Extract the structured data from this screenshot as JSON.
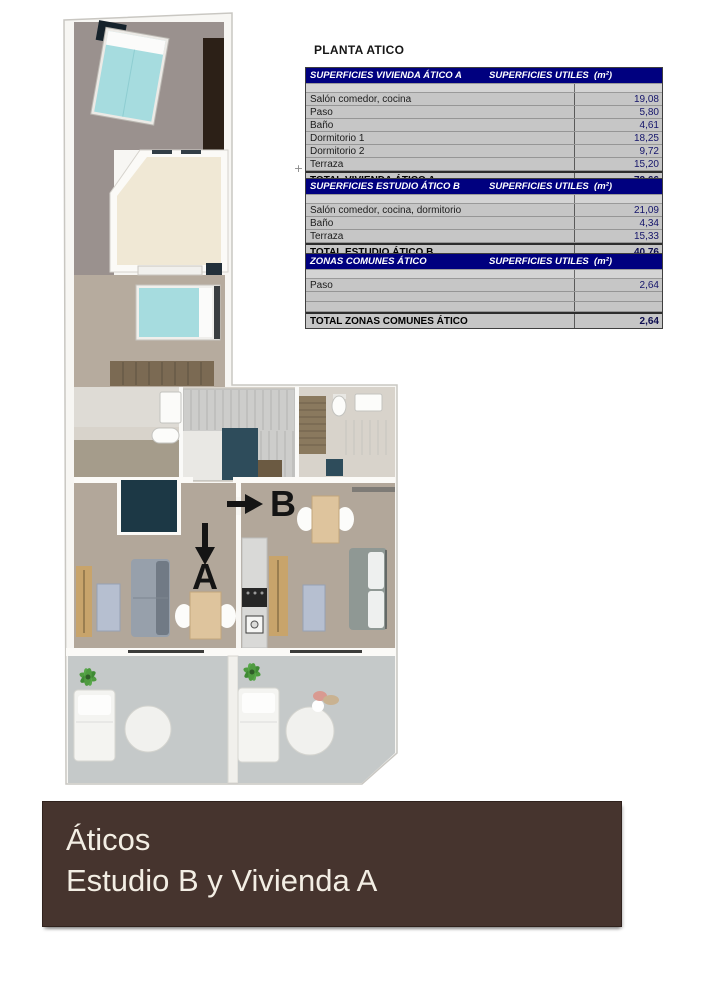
{
  "page": {
    "title": "PLANTA ATICO"
  },
  "plan": {
    "unit_a_label": "A",
    "unit_b_label": "B"
  },
  "markers": {
    "outline_plus": "+"
  },
  "tables": {
    "vivienda_a": {
      "header_left": "SUPERFICIES VIVIENDA ÁTICO A",
      "header_right": "SUPERFICIES UTILES  (m²)",
      "rows": [
        {
          "label": "Salón comedor, cocina",
          "value": "19,08"
        },
        {
          "label": "Paso",
          "value": "5,80"
        },
        {
          "label": "Baño",
          "value": "4,61"
        },
        {
          "label": "Dormitorio 1",
          "value": "18,25"
        },
        {
          "label": "Dormitorio 2",
          "value": "9,72"
        },
        {
          "label": "Terraza",
          "value": "15,20"
        }
      ],
      "total_label": "TOTAL VIVIENDA ÁTICO A",
      "total_value": "72,66"
    },
    "estudio_b": {
      "header_left": "SUPERFICIES ESTUDIO ÁTICO B",
      "header_right": "SUPERFICIES UTILES  (m²)",
      "rows": [
        {
          "label": "Salón comedor, cocina, dormitorio",
          "value": "21,09"
        },
        {
          "label": "Baño",
          "value": "4,34"
        },
        {
          "label": "Terraza",
          "value": "15,33"
        }
      ],
      "total_label": "TOTAL ESTUDIO ÁTICO B",
      "total_value": "40,76"
    },
    "zonas_comunes": {
      "header_left": "ZONAS COMUNES ÁTICO",
      "header_right": "SUPERFICIES UTILES  (m²)",
      "rows": [
        {
          "label": "Paso",
          "value": "2,64"
        },
        {
          "label": "",
          "value": ""
        },
        {
          "label": "",
          "value": ""
        }
      ],
      "total_label": "TOTAL ZONAS COMUNES ÁTICO",
      "total_value": "2,64"
    }
  },
  "footer": {
    "line1": "Áticos",
    "line2": "Estudio B y Vivienda A"
  },
  "colors": {
    "table_header_bg": "#00007f",
    "table_row_bg": "#c6c6c6",
    "value_text": "#15156b",
    "banner_bg": "#46342e",
    "banner_text": "#f3eee4",
    "bed_teal": "#a6dcdf",
    "terrace_cream": "#f0e8d5",
    "shower_navy": "#1c3845"
  }
}
